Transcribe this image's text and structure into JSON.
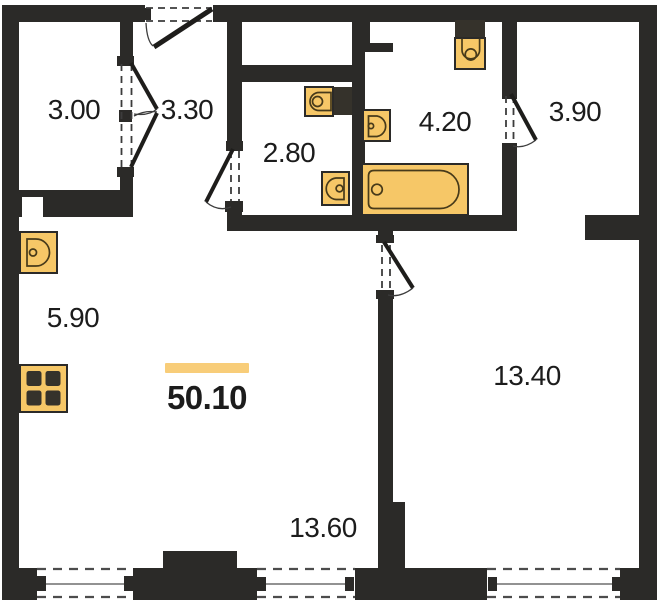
{
  "plan": {
    "kind": "apartment-floor-plan",
    "total_area": "50.10",
    "rooms": [
      {
        "name": "closet",
        "area": "3.00"
      },
      {
        "name": "hallway",
        "area": "3.30"
      },
      {
        "name": "wc",
        "area": "2.80"
      },
      {
        "name": "bathroom",
        "area": "4.20"
      },
      {
        "name": "dressing-room",
        "area": "3.90"
      },
      {
        "name": "kitchen-zone",
        "area": "5.90"
      },
      {
        "name": "bedroom",
        "area": "13.40"
      },
      {
        "name": "living-zone",
        "area": "13.60"
      }
    ],
    "fixtures": [
      {
        "name": "kitchen-sink-icon"
      },
      {
        "name": "stove-icon"
      },
      {
        "name": "toilet-icon"
      },
      {
        "name": "washbasin-icon"
      },
      {
        "name": "toilet-icon"
      },
      {
        "name": "washbasin-icon"
      },
      {
        "name": "bathtub-icon"
      }
    ],
    "colors": {
      "wall": "#2b2a28",
      "fixture_fill": "#f6c767",
      "fixture_line": "#473a1a",
      "fixture_dark": "#35322b",
      "accent_bar": "#f8cd79",
      "text": "#1c1c1c",
      "dash": "#3c3c3c"
    }
  }
}
